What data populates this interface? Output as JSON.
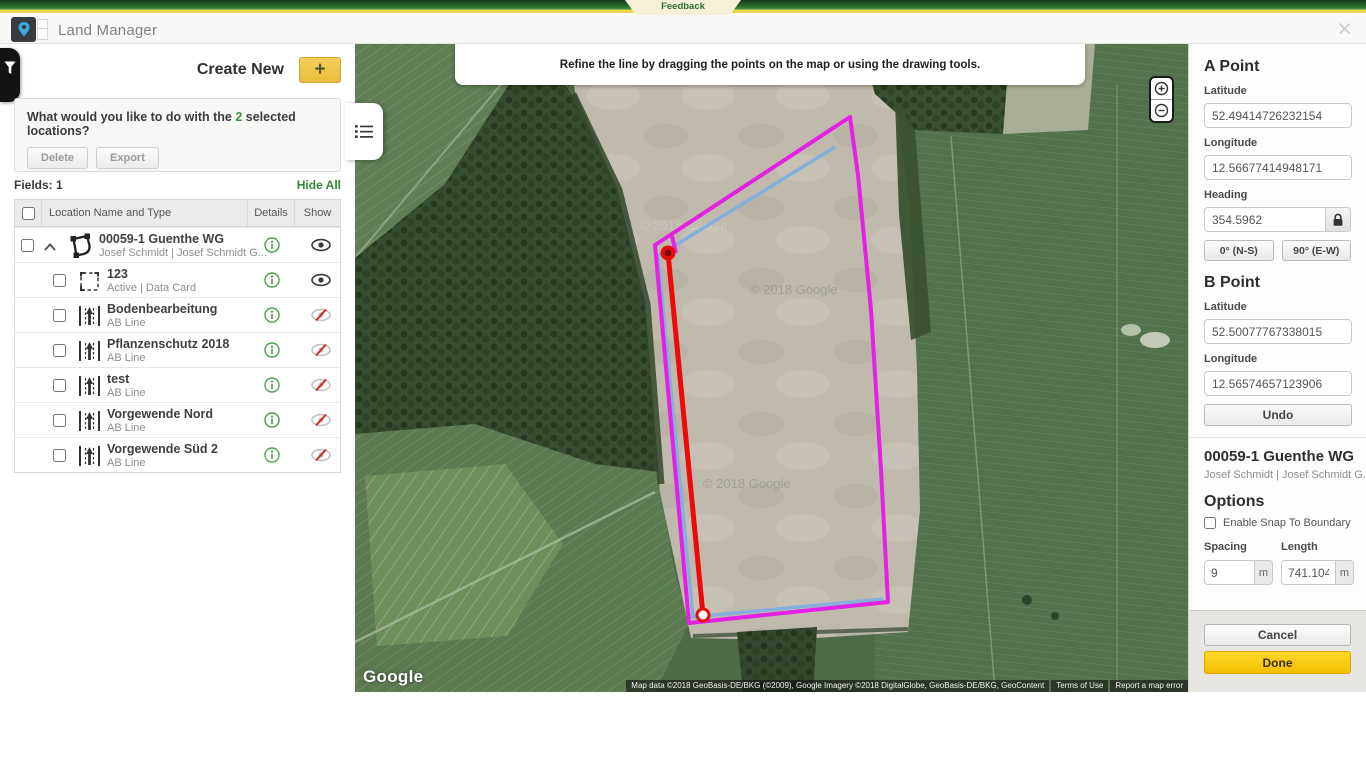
{
  "feedback_bar": {
    "label": "Feedback"
  },
  "header": {
    "title": "Land Manager",
    "close": "×"
  },
  "sidebar": {
    "create_new_label": "Create New",
    "plus_label": "+",
    "selection_prompt": {
      "pre": "What would you like to do with the ",
      "count": "2",
      "post": " selected locations?"
    },
    "actions": {
      "delete": "Delete",
      "export": "Export"
    },
    "fields_count_label": "Fields: 1",
    "hide_all_label": "Hide All",
    "table": {
      "headers": {
        "name": "Location Name and Type",
        "details": "Details",
        "show": "Show"
      },
      "rows": [
        {
          "name": "00059-1 Guenthe WG",
          "subtitle": "Josef Schmidt | Josef Schmidt G...",
          "icon": "boundary-polygon-icon",
          "visible": true
        },
        {
          "name": "123",
          "subtitle": "Active | Data Card",
          "icon": "dashed-boundary-icon",
          "visible": true
        },
        {
          "name": "Bodenbearbeitung",
          "subtitle": "AB Line",
          "icon": "ab-line-icon",
          "visible": false
        },
        {
          "name": "Pflanzenschutz 2018",
          "subtitle": "AB Line",
          "icon": "ab-line-icon",
          "visible": false
        },
        {
          "name": "test",
          "subtitle": "AB Line",
          "icon": "ab-line-icon",
          "visible": false
        },
        {
          "name": "Vorgewende Nord",
          "subtitle": "AB Line",
          "icon": "ab-line-icon",
          "visible": false
        },
        {
          "name": "Vorgewende Süd 2",
          "subtitle": "AB Line",
          "icon": "ab-line-icon",
          "visible": false
        }
      ]
    }
  },
  "map": {
    "banner": "Refine the line by dragging the points on the map or using the drawing tools.",
    "watermark": "© 2018 Google",
    "google_logo": "Google",
    "attribution": "Map data ©2018 GeoBasis-DE/BKG (©2009), Google Imagery ©2018 DigitalGlobe, GeoBasis-DE/BKG, GeoContent",
    "terms": "Terms of Use",
    "report": "Report a map error"
  },
  "panel": {
    "a_point": {
      "title": "A Point",
      "latitude_label": "Latitude",
      "latitude": "52.49414726232154",
      "longitude_label": "Longitude",
      "longitude": "12.56677414948171",
      "heading_label": "Heading",
      "heading": "354.5962",
      "ns_button": "0° (N-S)",
      "ew_button": "90° (E-W)"
    },
    "b_point": {
      "title": "B Point",
      "latitude_label": "Latitude",
      "latitude": "52.50077767338015",
      "longitude_label": "Longitude",
      "longitude": "12.56574657123906",
      "undo_button": "Undo"
    },
    "field": {
      "name": "00059-1 Guenthe WG",
      "subtitle": "Josef Schmidt | Josef Schmidt G..."
    },
    "options": {
      "title": "Options",
      "snap_label": "Enable Snap To Boundary",
      "spacing_label": "Spacing",
      "spacing_value": "9",
      "length_label": "Length",
      "length_value": "741.104",
      "unit": "m"
    },
    "footer": {
      "cancel": "Cancel",
      "done": "Done"
    }
  },
  "colors": {
    "accent_green": "#2f8a33",
    "accent_yellow": "#f2c84b",
    "boundary_magenta": "#e420e4",
    "ab_line_red": "#ee0808",
    "guidance_blue": "#84aede"
  }
}
